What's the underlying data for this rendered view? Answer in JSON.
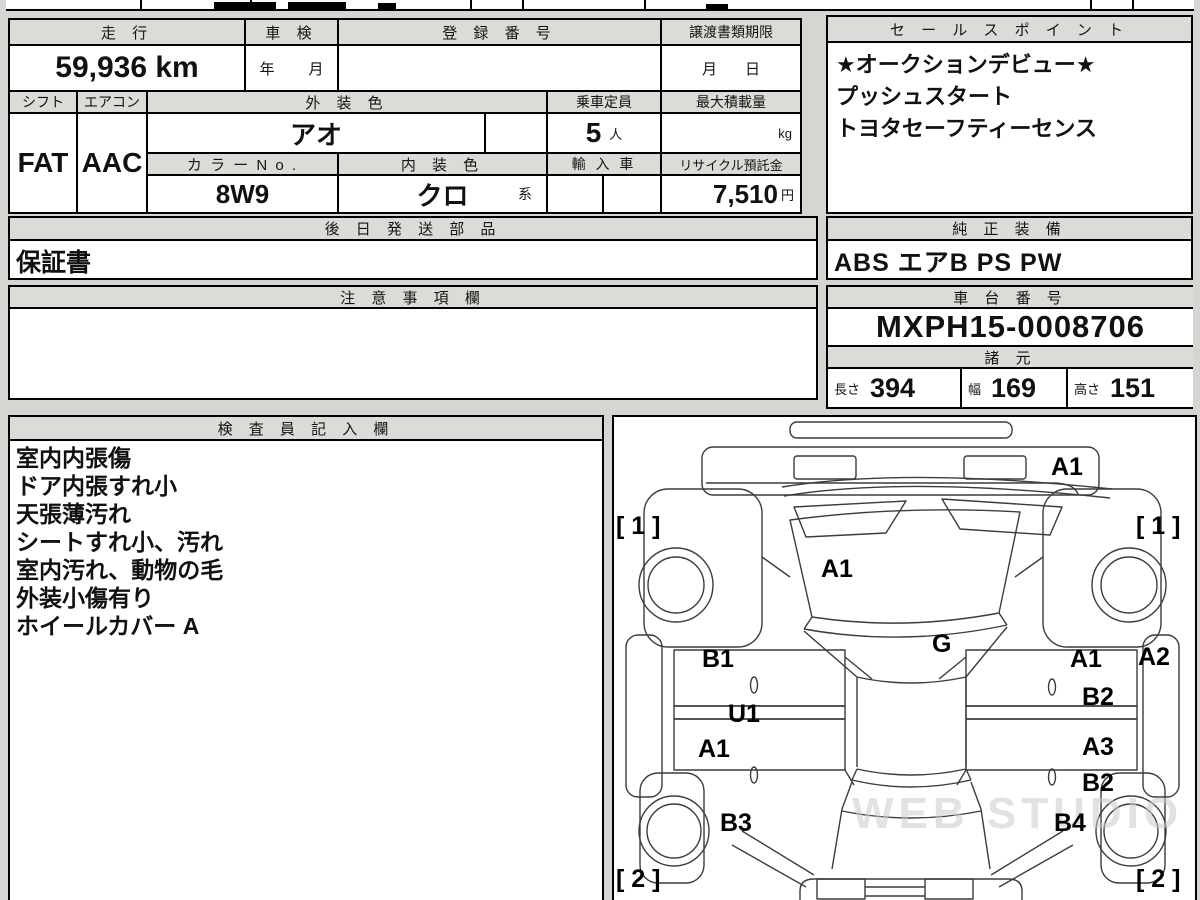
{
  "info_table": {
    "headers": {
      "mileage": "走 行",
      "inspection": "車 検",
      "registration": "登 録 番 号",
      "transfer_deadline": "譲渡書類期限",
      "shift": "シフト",
      "aircon": "エアコン",
      "exterior_color": "外 装 色",
      "capacity": "乗車定員",
      "max_load": "最大積載量",
      "color_no": "カ ラ ー N o .",
      "interior_color": "内 装 色",
      "import_car": "輸 入 車",
      "recycle_deposit": "リサイクル預託金"
    },
    "values": {
      "mileage": "59,936 km",
      "inspection_year_label": "年",
      "inspection_month_label": "月",
      "deadline_month_label": "月",
      "deadline_day_label": "日",
      "shift": "FAT",
      "aircon": "AAC",
      "exterior_color": "アオ",
      "capacity": "5",
      "capacity_unit": "人",
      "max_load_unit": "kg",
      "color_no": "8W9",
      "interior_color": "クロ",
      "interior_color_suffix": "系",
      "recycle_deposit": "7,510",
      "recycle_deposit_unit": "円"
    }
  },
  "sales_point": {
    "title": "セ ー ル ス ポ イ ン ト",
    "lines": [
      "★オークションデビュー★",
      "プッシュスタート",
      "トヨタセーフティーセンス"
    ]
  },
  "later_parts": {
    "title": "後 日 発 送 部 品",
    "value": "保証書"
  },
  "genuine_equipment": {
    "title": "純 正 装 備",
    "value": "ABS エアB PS PW"
  },
  "notes": {
    "title": "注 意 事 項 欄",
    "value": ""
  },
  "chassis": {
    "title": "車 台 番 号",
    "value": "MXPH15-0008706"
  },
  "specs": {
    "title": "諸 元",
    "length_label": "長さ",
    "length": "394",
    "width_label": "幅",
    "width": "169",
    "height_label": "高さ",
    "height": "151"
  },
  "inspector": {
    "title": "検 査 員 記 入 欄",
    "lines": [
      "室内内張傷",
      "ドア内張すれ小",
      "天張薄汚れ",
      "シートすれ小、汚れ",
      "室内汚れ、動物の毛",
      "外装小傷有り",
      "ホイールカバー A"
    ]
  },
  "diagram": {
    "watermark": "WEB STUDIO PRO",
    "labels": [
      {
        "t": "A1",
        "x": 437,
        "y": 36
      },
      {
        "t": "[ 1 ]",
        "x": 2,
        "y": 95
      },
      {
        "t": "[ 1 ]",
        "x": 522,
        "y": 95
      },
      {
        "t": "A1",
        "x": 207,
        "y": 138
      },
      {
        "t": "G",
        "x": 318,
        "y": 213
      },
      {
        "t": "B1",
        "x": 88,
        "y": 228
      },
      {
        "t": "U1",
        "x": 114,
        "y": 283
      },
      {
        "t": "A1",
        "x": 84,
        "y": 318
      },
      {
        "t": "B3",
        "x": 106,
        "y": 392
      },
      {
        "t": "A1",
        "x": 456,
        "y": 228
      },
      {
        "t": "A2",
        "x": 524,
        "y": 226
      },
      {
        "t": "B2",
        "x": 468,
        "y": 266
      },
      {
        "t": "A3",
        "x": 468,
        "y": 316
      },
      {
        "t": "B2",
        "x": 468,
        "y": 352
      },
      {
        "t": "B4",
        "x": 440,
        "y": 392
      },
      {
        "t": "[ 2 ]",
        "x": 2,
        "y": 448
      },
      {
        "t": "[ 2 ]",
        "x": 522,
        "y": 448
      }
    ]
  }
}
